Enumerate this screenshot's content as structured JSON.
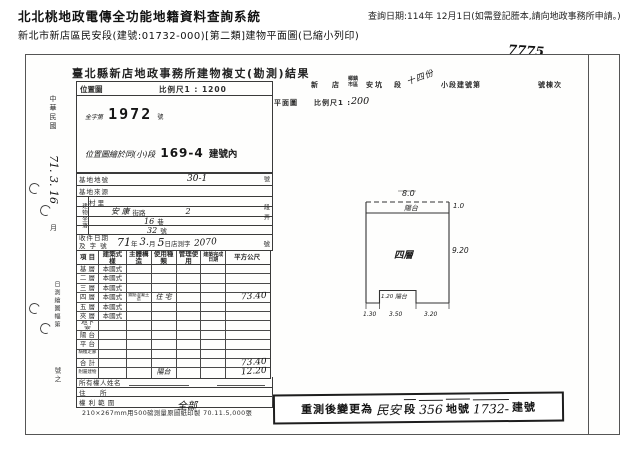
{
  "header": {
    "system_title": "北北桃地政電傳全功能地籍資料查詢系統",
    "query_date": "查詢日期:114年 12月1日(如需登記謄本,請向地政事務所申請。)",
    "doc_desc": "新北市新店區民安段(建號:01732-000)[第二類]建物平面圖(已縮小列印)"
  },
  "doc": {
    "title": "臺北縣新店地政事務所建物複丈(勘測)結果",
    "margin": {
      "era": "中華民國",
      "hw_date": "71. 3. 16",
      "month": "月",
      "survey_note": "日測繪圖幅第",
      "survey_suffix": "號之"
    },
    "loc_box": {
      "label": "位置圖",
      "scale": "比例尺1 : 1200",
      "case_prefix": "全字第",
      "case_no": "1972",
      "case_suffix": "號",
      "note": "位置圖繪於同(小)段",
      "note_no": "169-4",
      "note_suffix": "建號內"
    },
    "site": {
      "lot_label": "基地地號",
      "lot_value": "30-1",
      "lot_unit": "號",
      "source_label": "基地來源",
      "situs_label": "建物坐落",
      "village_label": "村 里",
      "street_value": "安 康",
      "street_label": "街路",
      "sect_value": "2",
      "sect_label": "段",
      "lane_value": "16",
      "lane_label": "巷",
      "alley_label": "弄",
      "door_value": "32",
      "door_label": "號"
    },
    "intake": {
      "label_top": "收件日期",
      "label_bottom": "及 字 號",
      "year": "71",
      "year_l": "年",
      "month": "3.",
      "month_l": "月",
      "day": "5",
      "day_l": "日店測字",
      "no": "2070",
      "no_l": "號"
    },
    "grid": {
      "headers": [
        "項 目",
        "建築式樣",
        "主體構造",
        "使用種類",
        "管理使用",
        "建築完成日期",
        "平方公尺"
      ],
      "rows": [
        {
          "label": "基 層",
          "style": "本國式"
        },
        {
          "label": "二 層",
          "style": "本國式"
        },
        {
          "label": "三 層",
          "style": "本國式"
        },
        {
          "label": "四 層",
          "style": "本國式",
          "struct": "鋼筋混凝土造",
          "use": "住 宅",
          "area": "73.40"
        },
        {
          "label": "五 層",
          "style": "本國式"
        },
        {
          "label": "夾 層",
          "style": "本國式"
        },
        {
          "label": "地下室"
        },
        {
          "label": "陽 台"
        },
        {
          "label": "平 台"
        },
        {
          "label": "騎樓走廊"
        },
        {
          "label": "合 計",
          "area": "73.40"
        },
        {
          "label": "附屬建物",
          "use": "陽台",
          "area": "12.20"
        }
      ]
    },
    "owner": {
      "name_label": "所有權人姓名",
      "addr_label": "住　　所",
      "rights_label": "權 利 範 圍",
      "rights_value": "全部"
    },
    "print_note": "210×267mm用500磅測量原圖紙印製 70.11.5,000張",
    "right_head": {
      "hw_no": "7775",
      "twp1": "新",
      "twp2": "店",
      "twp_label": "鄉鎮市區",
      "sec_value": "安坑",
      "sec_label": "段",
      "subsec_hw": "十四份",
      "subsec_label": "小段建號第",
      "unit_label": "號棟次",
      "plan_label": "平面圖",
      "plan_scale": "比例尺1 :",
      "plan_scale_hw": "200"
    },
    "plan": {
      "dim_top": "8.0",
      "balcony": "陽台",
      "dim_balcony_depth": "1.0",
      "dim_right": "9.20",
      "floor": "四層",
      "notch_depth": "1.20",
      "notch_label": "陽台",
      "dim_b_left": "1.30",
      "dim_b_mid": "3.50",
      "dim_b_right": "3.20"
    },
    "stamp": {
      "prefix": "重測後變更為",
      "sec_hw": "民安",
      "sec_l": "段",
      "lot_hw": "356",
      "lot_l": "地號",
      "bno_hw": "1732-",
      "bno_l": "建號"
    }
  }
}
